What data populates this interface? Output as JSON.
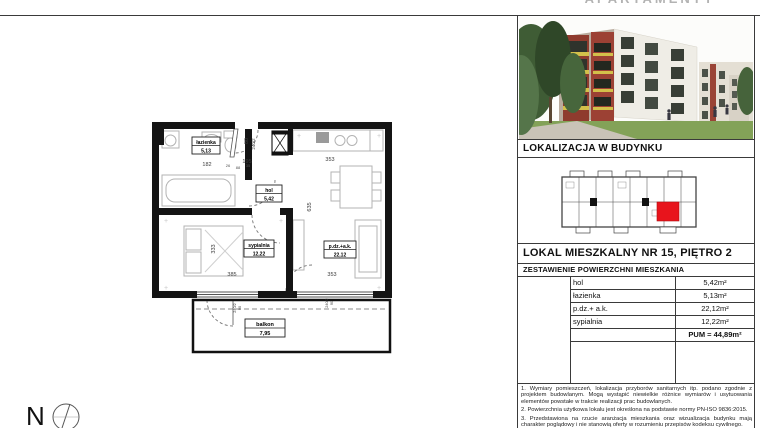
{
  "sheet": {
    "logo_text": "APARTAMENTY",
    "compass_label": "N"
  },
  "panel": {
    "location_header": "LOKALIZACJA W BUDYNKU",
    "unit_title": "LOKAL MIESZKALNY NR 15, PIĘTRO 2",
    "table_header": "ZESTAWIENIE POWIERZCHNI MIESZKANIA",
    "rows": [
      {
        "label": "hol",
        "value": "5,42m²"
      },
      {
        "label": "łazienka",
        "value": "5,13m²"
      },
      {
        "label": "p.dz.+ a.k.",
        "value": "22,12m²"
      },
      {
        "label": "sypialnia",
        "value": "12,22m²"
      }
    ],
    "total": "PUM = 44,89m²",
    "notes": [
      "1. Wymiary pomieszczeń, lokalizacja przyborów sanitarnych itp. podano zgodnie z projektem budowlanym. Mogą wystąpić niewielkie różnice wymiarów i usytuowania elementów powstałe w trakcie realizacji prac budowlanych.",
      "2. Powierzchnia użytkowa lokalu jest określona na podstawie normy PN-ISO 9836:2015.",
      "3. Przedstawiona na rzucie aranżacja mieszkania oraz wizualizacja budynku mają charakter poglądowy i nie stanowią oferty w rozumieniu przepisów kodeksu cywilnego."
    ]
  },
  "plan": {
    "rooms": [
      {
        "name": "łazienka",
        "area": "5,13"
      },
      {
        "name": "hol",
        "area": "5,42"
      },
      {
        "name": "sypialnia",
        "area": "12,22"
      },
      {
        "name": "p.dz.+a.k.",
        "area": "22,12"
      },
      {
        "name": "balkon",
        "area": "7,95"
      }
    ],
    "dims": {
      "bath_top": "182",
      "door_a": "26",
      "door_b": "88",
      "door_c": "35",
      "hall_top": "195",
      "living_top": "353",
      "entry_width": "80",
      "entry_frame": "240/2",
      "bedroom_height": "333",
      "living_height": "635",
      "bedroom_width": "385",
      "living_width": "353",
      "window_frame": "240/2",
      "window_sill": "90"
    }
  }
}
